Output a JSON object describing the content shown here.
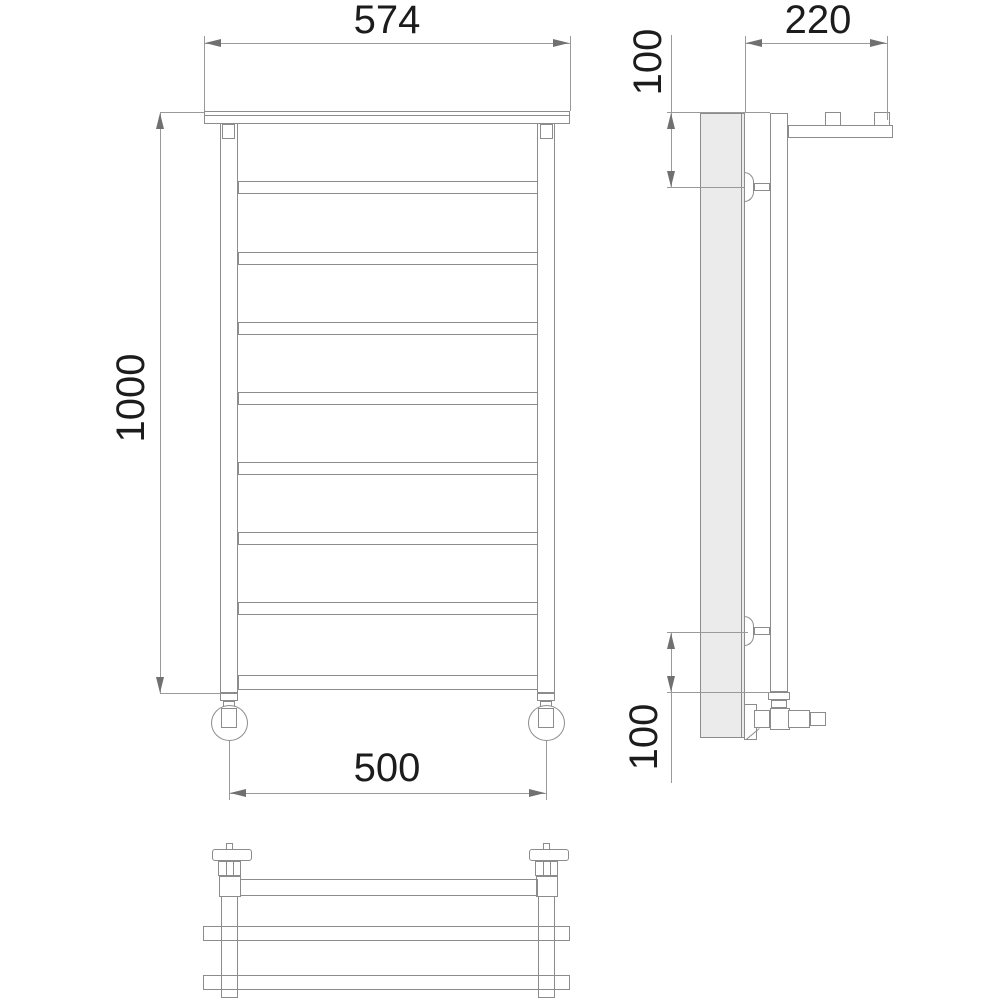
{
  "dimensions": {
    "front_top_width": "574",
    "front_height": "1000",
    "front_bottom_width": "500",
    "side_depth": "220",
    "side_top_offset": "100",
    "side_bottom_offset": "100"
  },
  "front_view": {
    "rung_y_positions": [
      181,
      252,
      322,
      392,
      462,
      532,
      602
    ],
    "bottom_tube_y": 675
  },
  "colors": {
    "object_line": "#8c8c8c",
    "dimension_line": "#9a9a9a",
    "arrow": "#707070",
    "text": "#1c1c1c",
    "wall_fill": "#ebebeb",
    "background": "#ffffff"
  }
}
